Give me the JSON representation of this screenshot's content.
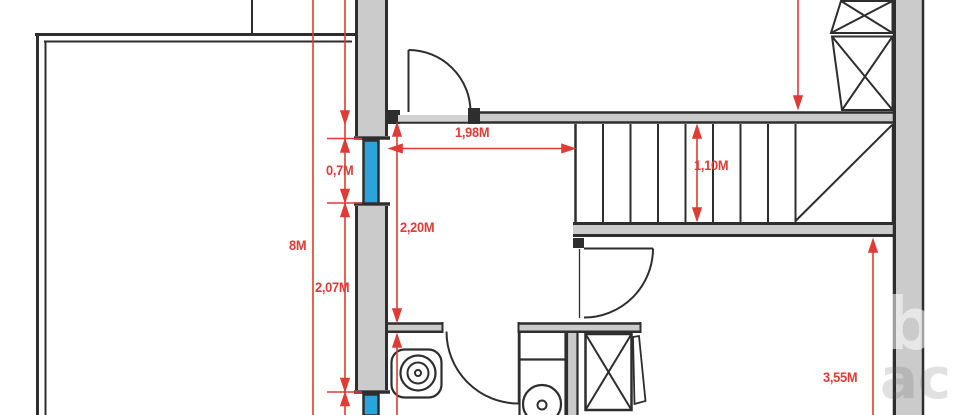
{
  "title": "Architectural floor plan with red dimension lines",
  "colors": {
    "background": "#ffffff",
    "wall_fill": "#cbcbcb",
    "line_dark": "#2e2e2e",
    "dimension_red": "#e03b35",
    "window_blue": "#2aa4da"
  },
  "dimension_labels": {
    "overall_height": "8M",
    "upper_window": "0,7M",
    "lower_wall_segment": "2,07M",
    "hallway_width": "1,98M",
    "hallway_height": "2,20M",
    "staircase_depth": "1,10M",
    "right_room_height": "3,55M"
  },
  "watermark": {
    "part1": "b",
    "part2": "ac"
  }
}
